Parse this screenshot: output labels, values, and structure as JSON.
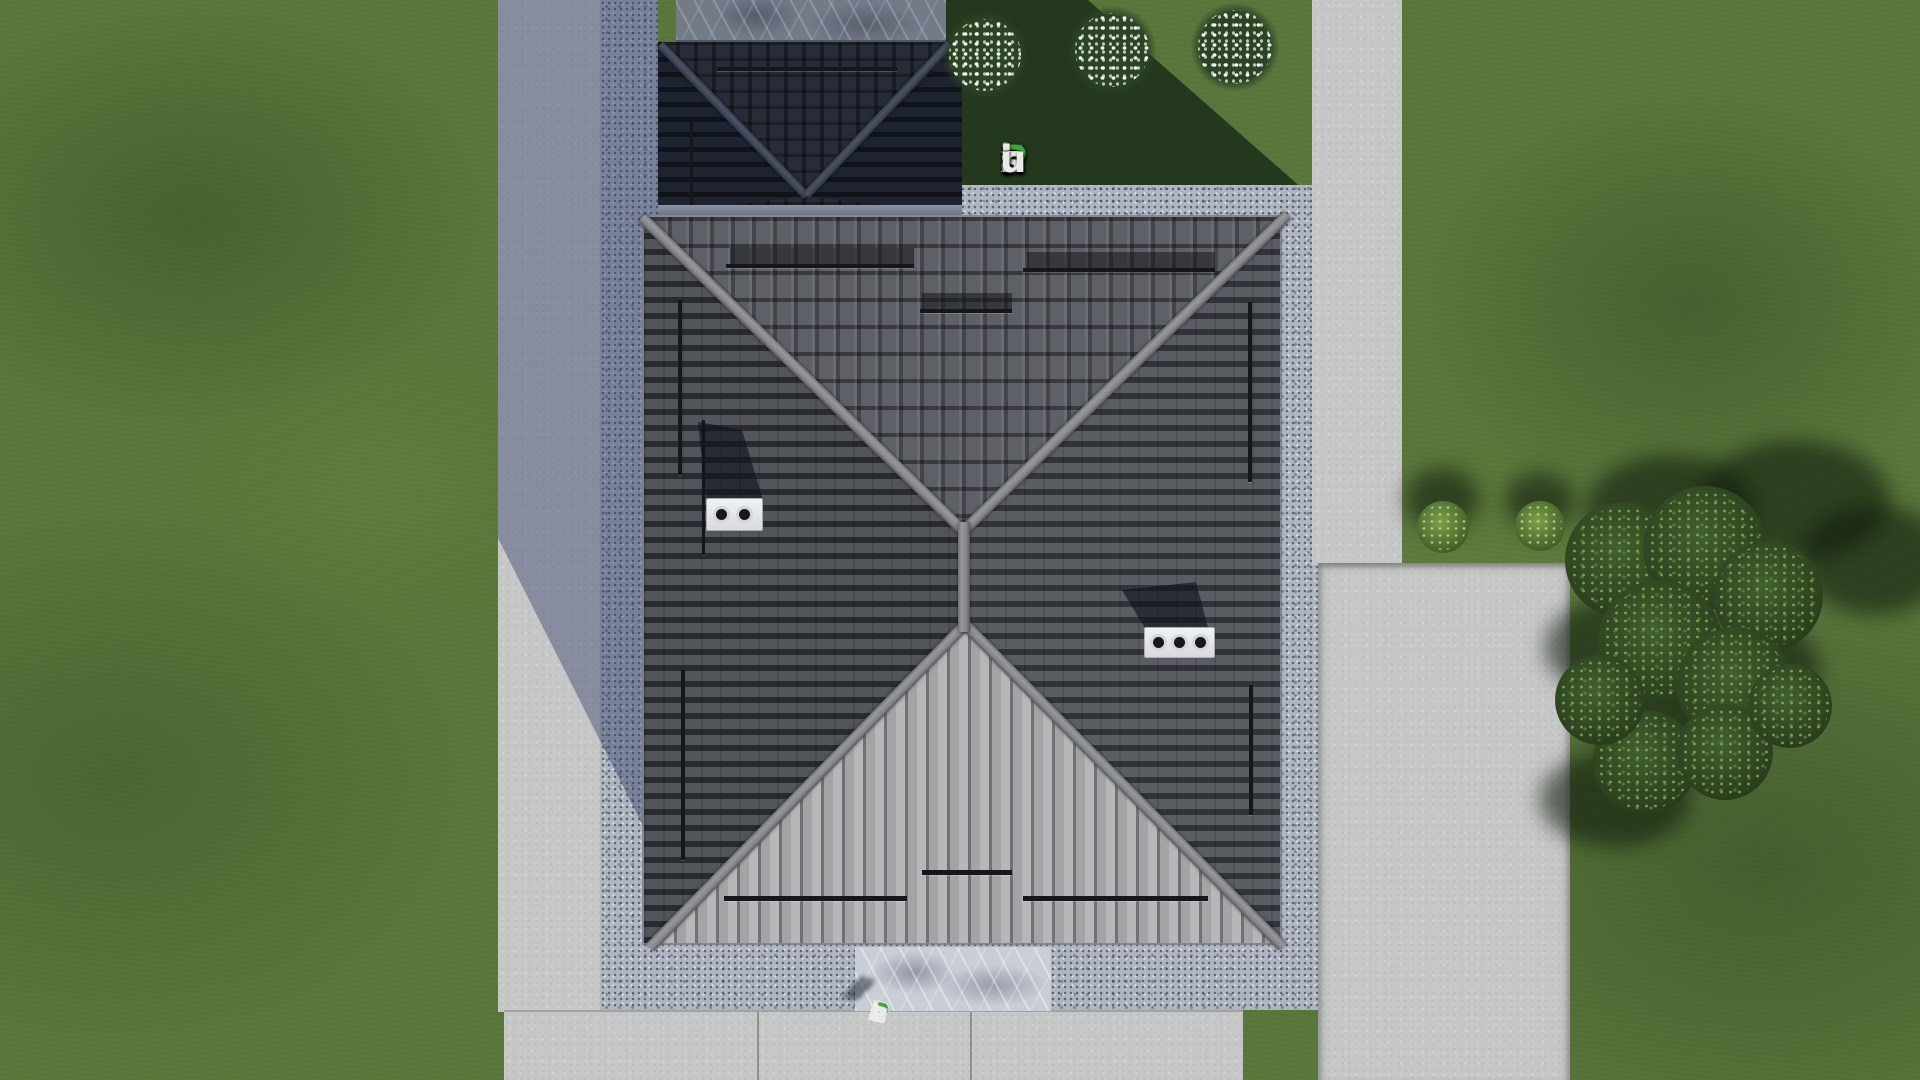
{
  "watermark": {
    "text": "FixPlans.ru",
    "letters": [
      {
        "ch": "F",
        "color": "#2b6ae3"
      },
      {
        "ch": "i",
        "color": "#e9e9e7",
        "dot": "#3fa832"
      },
      {
        "ch": "x",
        "color": "#e9e9e7"
      },
      {
        "ch": "P",
        "color": "#3fa832"
      },
      {
        "ch": "l",
        "color": "#e9e9e7"
      },
      {
        "ch": "a",
        "color": "#e9e9e7"
      },
      {
        "ch": "n",
        "color": "#e9e9e7"
      },
      {
        "ch": "s",
        "color": "#e9e9e7"
      },
      {
        "ch": ".",
        "color": "#2b6ae3"
      },
      {
        "ch": "r",
        "color": "#e9e9e7"
      },
      {
        "ch": "u",
        "color": "#e9e9e7"
      }
    ]
  },
  "ground_logo": {
    "text": "FixPlans.ru"
  },
  "palette": {
    "grass": "#5a783c",
    "grass-shadow": "#24381d",
    "concrete": "#cbcbc9",
    "driveway-shadow": "#80879e",
    "apron": "#b0b6c1",
    "roof-dark": "#53555c",
    "roof-light": "#b2b2b4",
    "garage-roof": "#272c38",
    "ridge": "#8b8d91",
    "logo-blue": "#2b6ae3",
    "logo-green": "#3fa832",
    "logo-white": "#e9e9e7"
  }
}
